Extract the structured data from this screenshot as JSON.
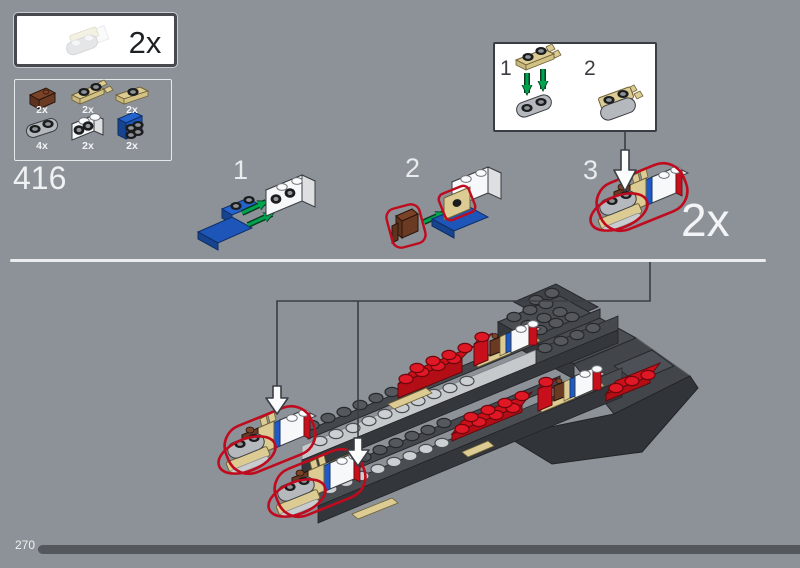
{
  "window": {
    "width": 800,
    "height": 568,
    "background": "#8C9298"
  },
  "header_box": {
    "quantity": "2x",
    "piece": "gray-rounded-plate-with-tan-clip-plate-ghost"
  },
  "parts_box": {
    "items": [
      {
        "part": "reddish-brown-bracket",
        "qty": "2x"
      },
      {
        "part": "tan-plate-with-clips",
        "qty": "2x"
      },
      {
        "part": "tan-jumper-plate-1x2",
        "qty": "2x"
      },
      {
        "part": "light-gray-rounded-plate-1x2",
        "qty": "4x"
      },
      {
        "part": "white-brick-1x2-side-studs",
        "qty": "2x"
      },
      {
        "part": "blue-bracket-1x2-2x2",
        "qty": "2x"
      }
    ]
  },
  "step": {
    "number": "416"
  },
  "substeps": [
    {
      "label": "1"
    },
    {
      "label": "2"
    },
    {
      "label": "3"
    }
  ],
  "inset": {
    "steps": [
      {
        "label": "1"
      },
      {
        "label": "2"
      }
    ]
  },
  "assembly": {
    "quantity": "2x"
  },
  "footer": {
    "page_number": "270"
  },
  "colors": {
    "background": "#8C9298",
    "divider": "#E9EBEC",
    "progress_bar": "#54585D",
    "highlight_red": "#C00A1E",
    "arrow_green": "#00A44F",
    "lego_red": "#C8101D",
    "lego_blue": "#1E55B8",
    "lego_tan": "#DCCB92",
    "lego_brown": "#6B3A23",
    "lego_dark_gray": "#3A3D42",
    "lego_light_gray": "#C6C9CC"
  }
}
